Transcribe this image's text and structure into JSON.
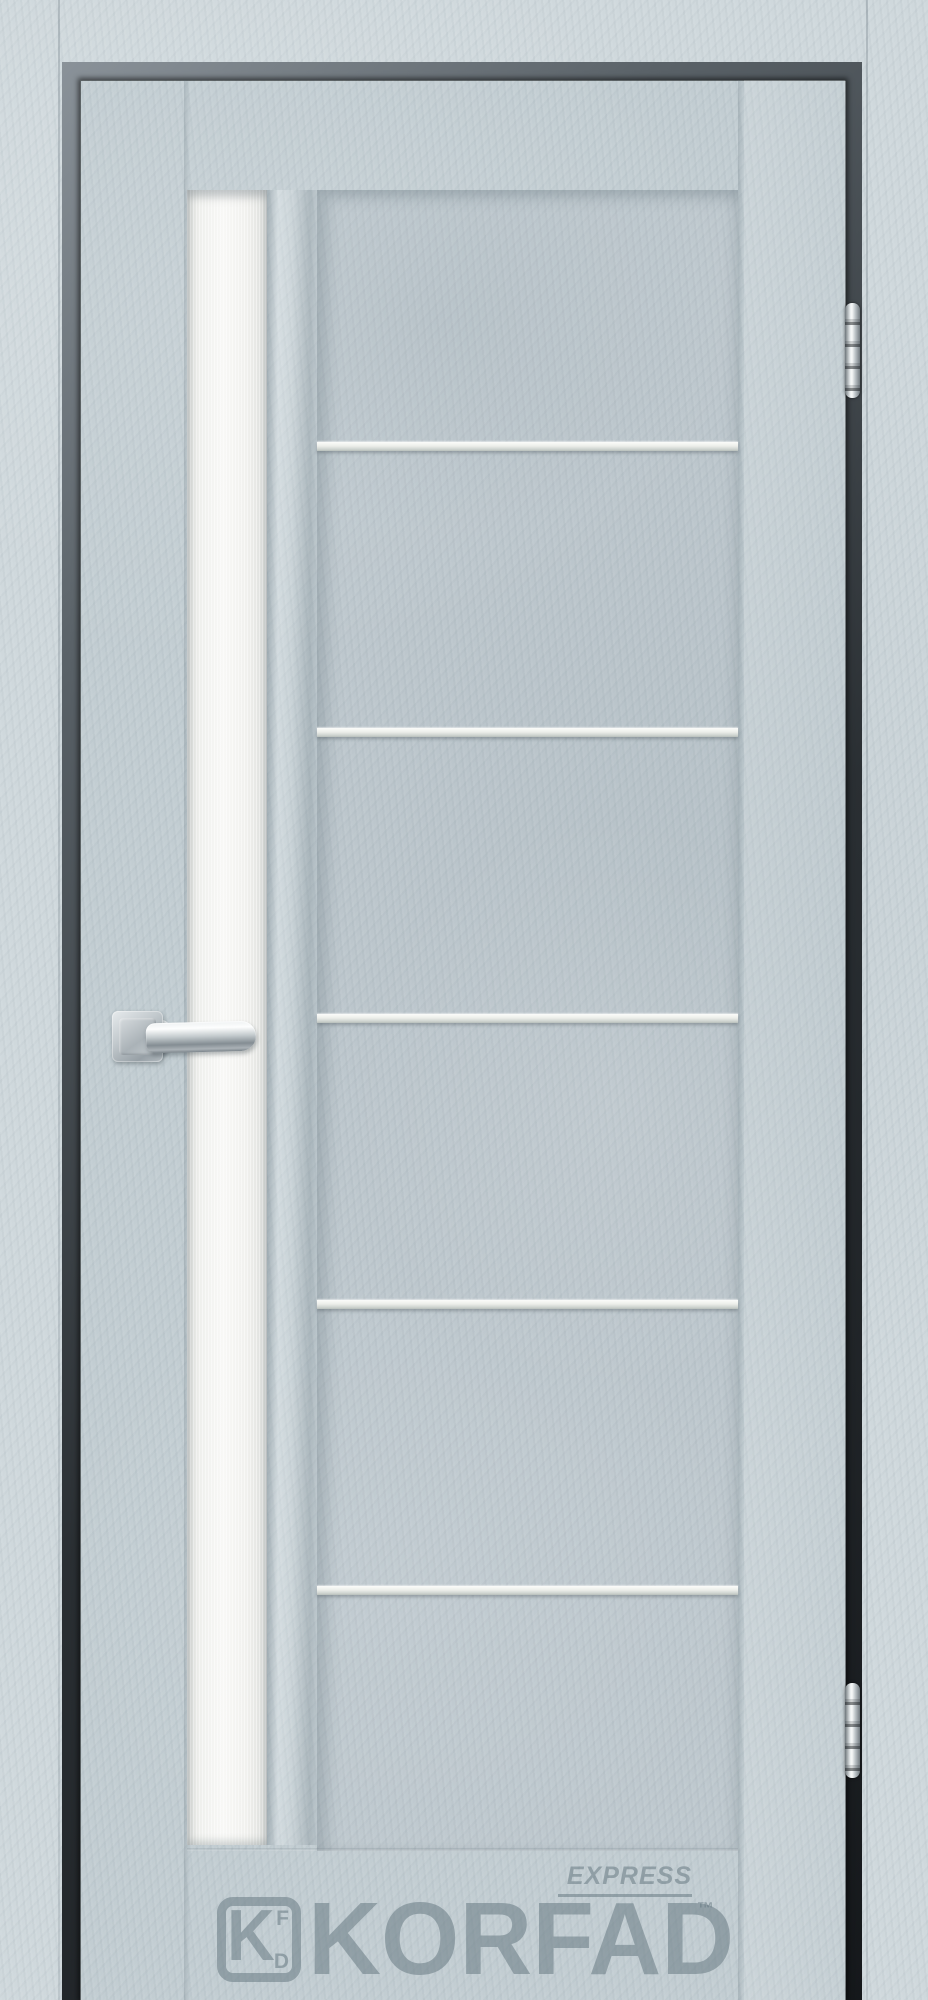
{
  "image": {
    "description": "Product photograph of a KORFAD EXPRESS interior door, light grey concrete-look finish, frosted white vertical glass insert on the left, chrome lever handle, five horizontal aluminium molding strips on the main panel, two chrome barrel hinges on the right edge, grey KORFAD watermark logo near the bottom"
  },
  "brand": {
    "wordmark": "KORFAD",
    "product_line": "EXPRESS",
    "trademark": "™",
    "monogram_main": "K",
    "monogram_top": "F",
    "monogram_bottom": "D"
  },
  "door": {
    "finish_colors": {
      "casing": "#cfd8dc",
      "leaf": "#c2cdd2",
      "glass_insert": "#f5f5f3",
      "reveal_gap": "#2a2f33",
      "aluminium_molding": "#e9ece9",
      "chrome_hardware": "#c3cacd",
      "watermark_grey": "#64767f"
    },
    "glass_insert": {
      "position": "left vertical strip",
      "top_y": 190,
      "bottom_y": 1845
    },
    "panel_molding_lines_y": [
      442,
      728,
      1014,
      1300,
      1586
    ]
  },
  "hardware": {
    "handle": {
      "type": "lever on square rosette",
      "finish": "satin chrome",
      "x": 112,
      "y": 1011
    },
    "hinges": [
      {
        "label": "top-hinge",
        "y": 303
      },
      {
        "label": "bottom-hinge",
        "y": 1683
      }
    ]
  }
}
